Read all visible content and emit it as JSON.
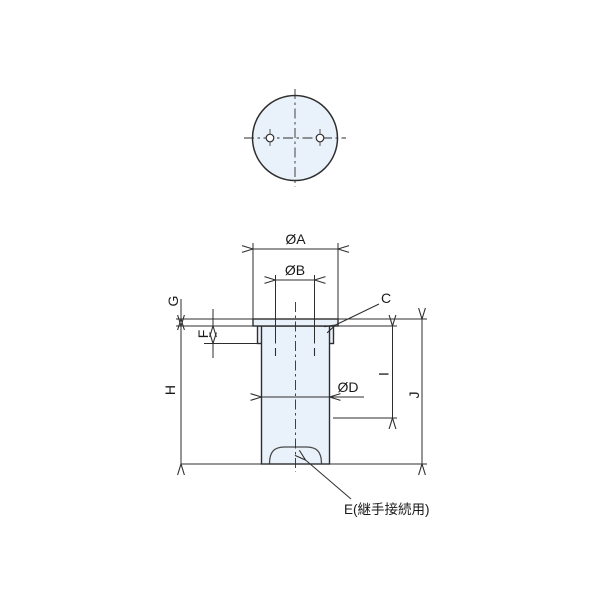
{
  "drawing": {
    "labels": {
      "dia_a": "ØA",
      "dia_b": "ØB",
      "dia_d": "ØD",
      "c": "C",
      "e": "E(継手接続用)",
      "f": "F",
      "g": "G",
      "h": "H",
      "i": "I",
      "j": "J"
    },
    "colors": {
      "part_fill": "#E9F2FB",
      "line": "#2E2E2E",
      "text": "#1A1A1A"
    }
  }
}
